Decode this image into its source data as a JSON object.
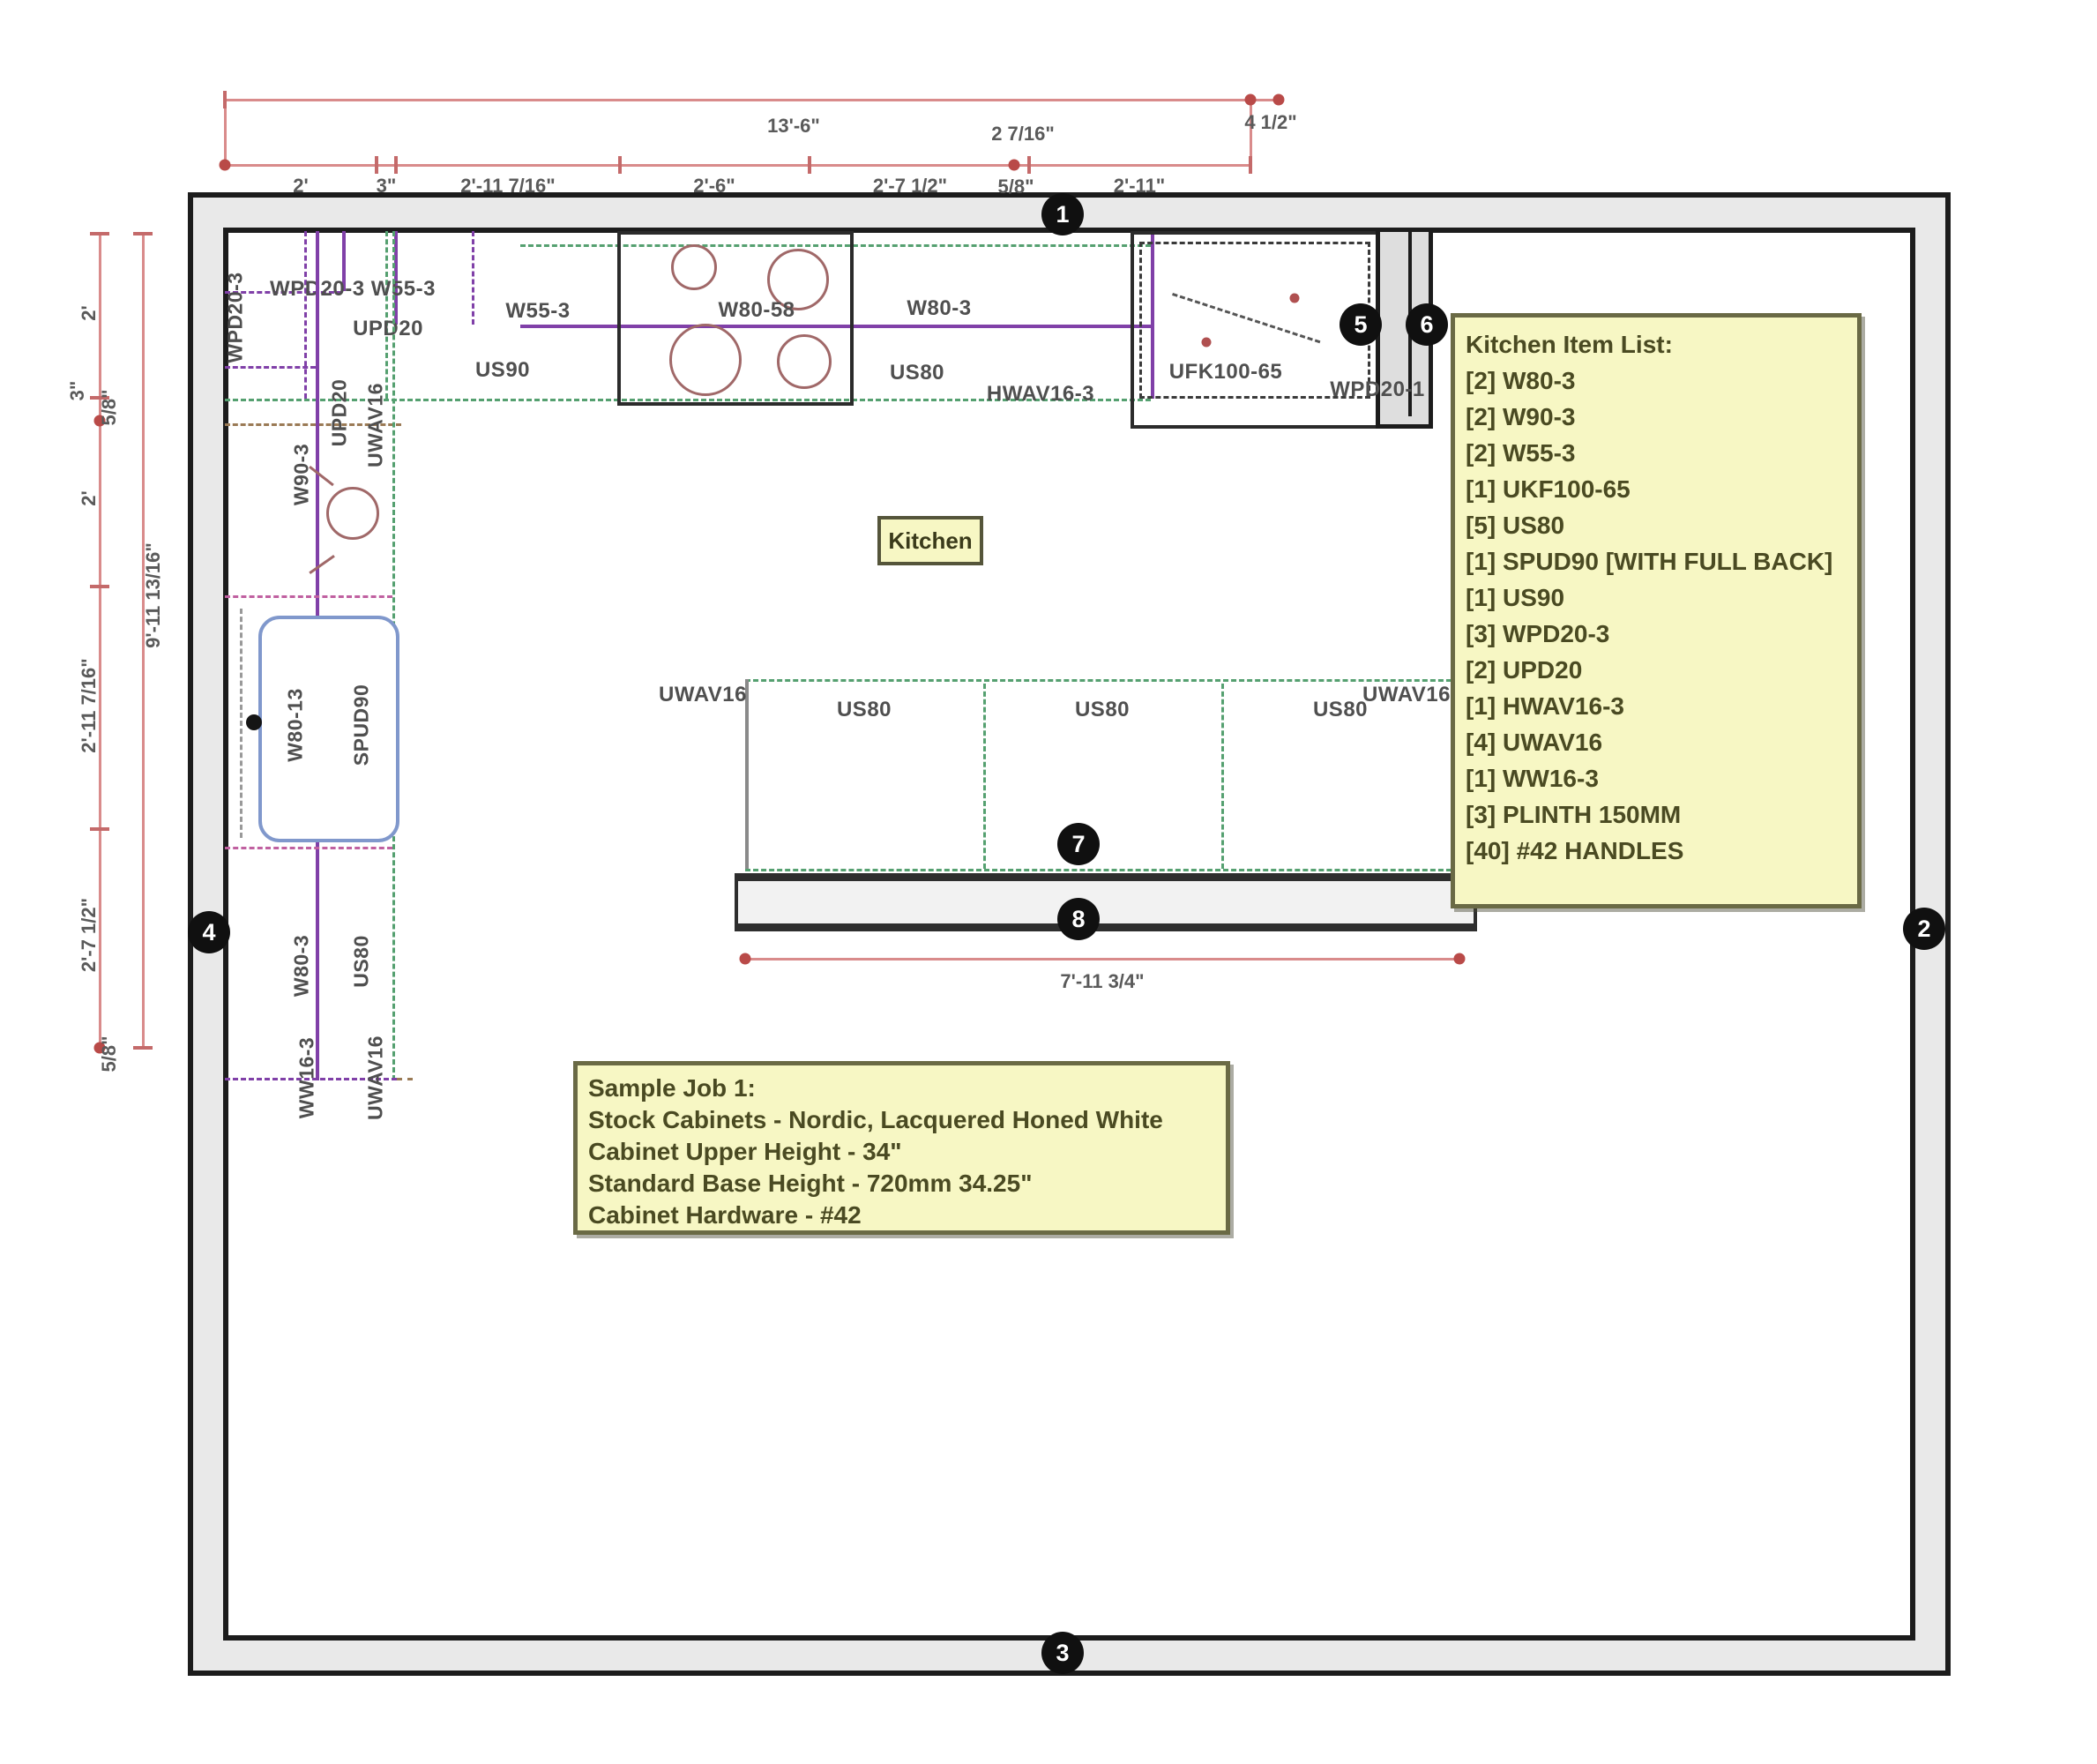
{
  "room": {
    "label": "Kitchen"
  },
  "dims_top": {
    "total": "13'-6\"",
    "extra": "4 1/2\"",
    "above_segment": "2 7/16\"",
    "segments": [
      "2'",
      "3\"",
      "2'-11 7/16\"",
      "2'-6\"",
      "2'-7 1/2\"",
      "5/8\"",
      "2'-11\""
    ]
  },
  "dims_left": {
    "total": "9'-11 13/16\"",
    "segments": [
      "2'",
      "3\"",
      "5/8\"",
      "2'",
      "2'-11 7/16\"",
      "2'-7 1/2\"",
      "5/8\""
    ]
  },
  "top_run": {
    "wall_pair": "WPD20-3 W55-3",
    "upd20": "UPD20",
    "w55": "W55-3",
    "us90": "US90",
    "cooktop": "W80-58",
    "w80": "W80-3",
    "us80": "US80",
    "hood": "HWAV16-3",
    "fridge": "UFK100-65",
    "wpd20_1": "WPD20-1"
  },
  "left_run": {
    "wpd20_3": "WPD20-3",
    "upd20": "UPD20",
    "uwav16_top": "UWAV16",
    "w90": "W90-3",
    "sink_side": "W80-13",
    "spud90": "SPUD90",
    "w80": "W80-3",
    "us80": "US80",
    "ww16": "WW16-3",
    "uwav16_bottom": "UWAV16"
  },
  "island": {
    "uwav16_left": "UWAV16",
    "uwav16_right": "UWAV16",
    "cabs": [
      "US80",
      "US80",
      "US80"
    ],
    "dim": "7'-11 3/4\""
  },
  "item_list": {
    "title": "Kitchen Item List:",
    "items": [
      "[2] W80-3",
      "[2] W90-3",
      "[2] W55-3",
      "[1] UKF100-65",
      "[5] US80",
      "[1] SPUD90 [WITH FULL BACK]",
      "[1] US90",
      "[3] WPD20-3",
      "[2] UPD20",
      "[1] HWAV16-3",
      "[4] UWAV16",
      "[1] WW16-3",
      "[3] PLINTH 150MM",
      "[40] #42 HANDLES"
    ]
  },
  "sample_job": {
    "lines": [
      "Sample Job 1:",
      "Stock Cabinets - Nordic, Lacquered Honed White",
      "Cabinet Upper Height - 34\"",
      "Standard Base Height - 720mm 34.25\"",
      "Cabinet Hardware - #42"
    ]
  },
  "markers": [
    "1",
    "2",
    "3",
    "4",
    "5",
    "6",
    "7",
    "8"
  ],
  "colors": {
    "dimension_red": "#d98b8b",
    "cabinet_purple": "#8040a8",
    "counter_green": "#55a070",
    "accent_magenta": "#c060a0",
    "trim_brown": "#9a7a55",
    "sink_blue": "#8098cc",
    "note_yellow": "#f7f7c4",
    "wall_gray": "#e9e9e9"
  }
}
